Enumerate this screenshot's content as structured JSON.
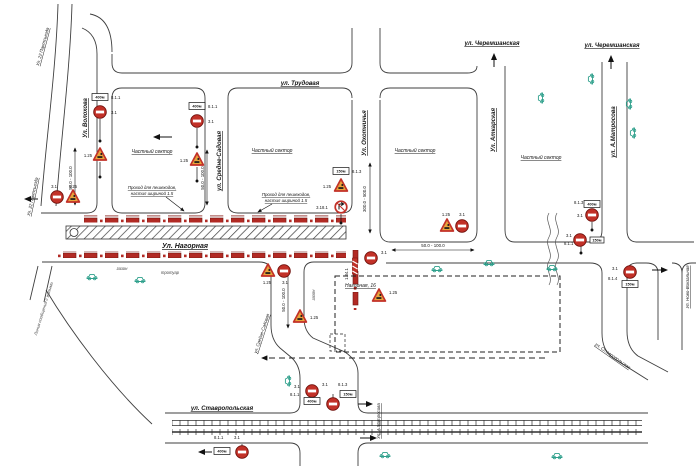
{
  "streets": {
    "nagornaya": "Ул. Нагорная",
    "trudovaya": "ул. Трудовая",
    "volokhova": "Ул. Волохова",
    "partsyezda": "Ул. 22 Партсъезда",
    "partsyezda2": "Ул. 22 Партсъезда",
    "sredne_sadovaya": "ул. Средне-Садовая",
    "sredne_sadovaya2": "ул. Средне-Садовая",
    "okhotnichya": "Ул. Охотничья",
    "atkarskaya": "Ул. Аткарская",
    "cheremshanskaya": "ул. Черемшанская",
    "cheremshanskaya2": "ул. Черемшанская",
    "matrosova": "ул. А.Матросова",
    "matrosova2": "Ул. А.Матросова",
    "novo_vokzalnaya": "Ул. Ново-Вокзальная",
    "stavropolskaya": "ул. Ставропольская",
    "stavropolskaya2": "ул. Ставропольская"
  },
  "areas": {
    "private1": "Частный сектор",
    "private2": "Частный сектор",
    "private3": "Частный сектор",
    "private4": "Частный сектор",
    "building": "Нагорная, 16",
    "lawn": "газон",
    "lawn2": "газон",
    "sidewalk": "тротуар"
  },
  "notes": {
    "ped1": "Проход для пешеходов,",
    "ped2": "настил шириной 1.5",
    "line_note": "Линия сообщения с жилыми"
  },
  "signs": {
    "no_entry": "3.1",
    "roadworks": "1.25",
    "no_turn": "3.18.1",
    "chevron": "1.34.1",
    "plate_811": "8.1.1",
    "plate_813": "8.1.3",
    "plate_814": "8.1.4",
    "dist_400": "400м",
    "dist_150": "150м"
  },
  "measurements": {
    "range_short": "50.0 - 100.0",
    "range_long": "300.0 - 500.0"
  },
  "colors": {
    "sign_red": "#c23128",
    "works_orange": "#e8a33b",
    "car_teal": "#2fa08c",
    "barrier_red": "#b22a24"
  }
}
